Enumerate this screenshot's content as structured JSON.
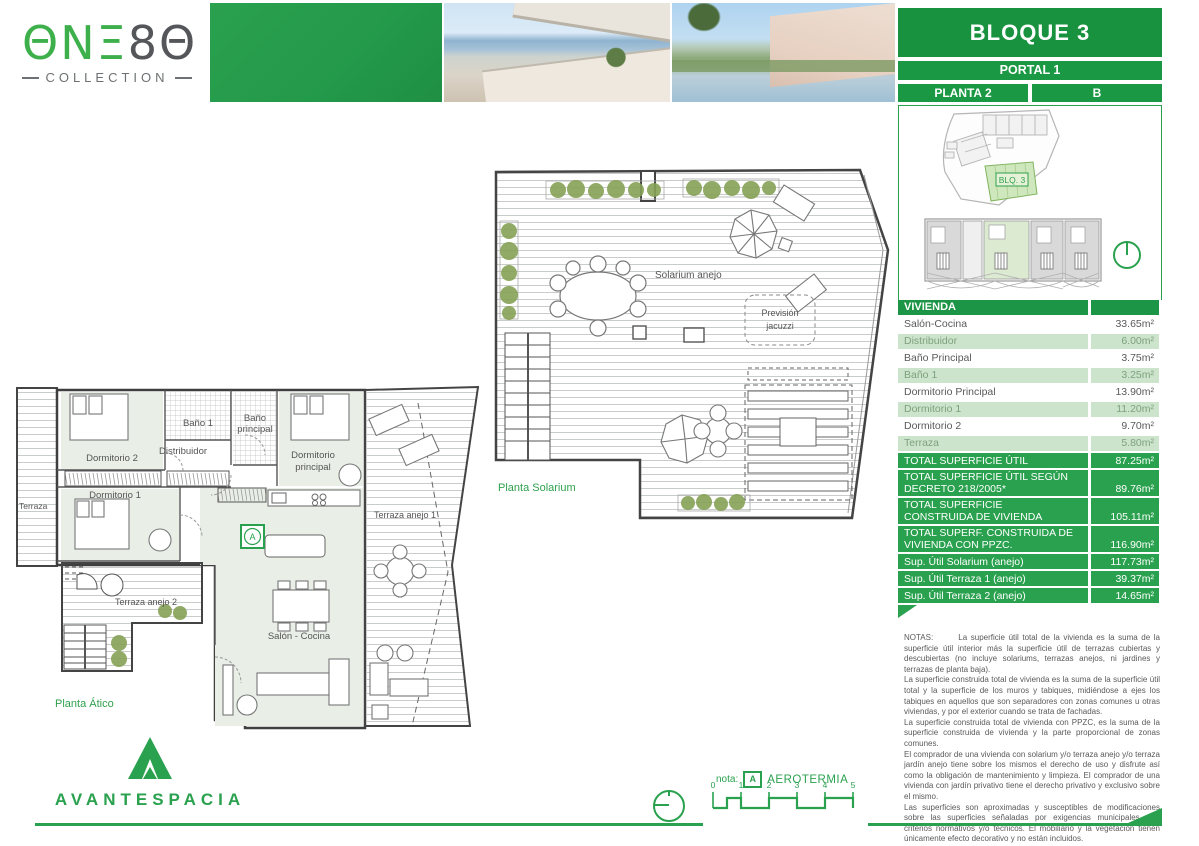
{
  "logo": {
    "green": "ΘNΞ",
    "gray": "8Θ",
    "subtitle": "COLLECTION"
  },
  "header": {
    "bloque": "BLOQUE 3",
    "portal": "PORTAL 1",
    "planta": "PLANTA 2",
    "letter": "B"
  },
  "siteplan": {
    "block_label": "BLQ. 3"
  },
  "table": {
    "header": "VIVIENDA",
    "rows": [
      {
        "label": "Salón-Cocina",
        "value": "33.65m²"
      },
      {
        "label": "Distribuidor",
        "value": "6.00m²"
      },
      {
        "label": "Baño Principal",
        "value": "3.75m²"
      },
      {
        "label": "Baño 1",
        "value": "3.25m²"
      },
      {
        "label": "Dormitorio Principal",
        "value": "13.90m²"
      },
      {
        "label": "Dormitorio 1",
        "value": "11.20m²"
      },
      {
        "label": "Dormitorio 2",
        "value": "9.70m²"
      },
      {
        "label": "Terraza",
        "value": "5.80m²"
      }
    ],
    "totals": [
      {
        "label": "TOTAL SUPERFICIE ÚTIL",
        "value": "87.25m²"
      },
      {
        "label": "TOTAL SUPERFICIE ÚTIL SEGÚN\nDECRETO 218/2005*",
        "value": "89.76m²"
      },
      {
        "label": "TOTAL SUPERFICIE\nCONSTRUIDA DE VIVIENDA",
        "value": "105.11m²"
      },
      {
        "label": "TOTAL SUPERF. CONSTRUIDA DE\nVIVIENDA CON PPZC.",
        "value": "116.90m²"
      },
      {
        "label": "Sup. Útil Solarium (anejo)",
        "value": "117.73m²"
      },
      {
        "label": "Sup. Útil Terraza 1 (anejo)",
        "value": "39.37m²"
      },
      {
        "label": "Sup. Útil Terraza 2 (anejo)",
        "value": "14.65m²"
      }
    ]
  },
  "notes": {
    "paragraphs": [
      "NOTAS:       La superficie útil total de la vivienda es la suma de la superficie útil interior más la superficie útil de terrazas cubiertas y descubiertas (no incluye solariums, terrazas anejos, ni jardines y terrazas de planta baja).",
      "La superficie construida total de vivienda es la suma de la superficie útil total y la superficie de los muros y tabiques, midiéndose a ejes los tabiques en aquellos que son separadores con zonas comunes u otras viviendas, y por el exterior cuando se trata de fachadas.",
      "La superficie construida total de vivienda con PPZC, es la suma de la superficie construida de vivienda y la parte proporcional de zonas comunes.",
      "El comprador de una vivienda con solarium y/o terraza anejo y/o terraza jardín anejo tiene sobre los mismos el derecho de uso y disfrute así como la obligación de mantenimiento y limpieza. El comprador de una vivienda con jardín privativo tiene el derecho privativo y exclusivo sobre el mismo.",
      "Las superficies son aproximadas y susceptibles de modificaciones sobre las superficies señaladas por exigencias municipales, por criterios normativos y/o técnicos. El mobiliario y la vegetación tienen únicamente efecto decorativo y no están incluidos.",
      "(*) Anexo 1. Reglamento de información al consumidor en la compraventa y arrendamiento de viviendas en Andalucía."
    ]
  },
  "plans": {
    "solarium": {
      "title": "Planta Solarium",
      "solarium_anejo": "Solarium anejo",
      "prevision_l1": "Previsión",
      "prevision_l2": "jacuzzi"
    },
    "atico": {
      "title": "Planta Ático",
      "terraza": "Terraza",
      "dorm2": "Dormitorio 2",
      "bano1": "Baño 1",
      "distribuidor": "Distribuidor",
      "bano_ppal_l1": "Baño",
      "bano_ppal_l2": "principal",
      "dorm_ppal_l1": "Dormitorio",
      "dorm_ppal_l2": "principal",
      "dorm1": "Dormitorio 1",
      "terraza_anejo1": "Terraza anejo 1",
      "terraza_anejo2": "Terraza anejo 2",
      "salon": "Salón - Cocina",
      "aerotermia_badge": "A"
    }
  },
  "footer": {
    "nota_label": "nota:",
    "aerotermia_badge": "A",
    "aerotermia": "AEROTERMIA",
    "scale_ticks": {
      "t0": "0",
      "t1": "1",
      "t2": "2",
      "t3": "3",
      "t4": "4",
      "t5": "5"
    }
  },
  "brand": {
    "name": "AVANTESPACIA"
  },
  "colors": {
    "primary_green": "#2aa14e",
    "band_green": "#1b9843",
    "light_row": "#cde4cc",
    "logo_green": "#3eb04b"
  }
}
